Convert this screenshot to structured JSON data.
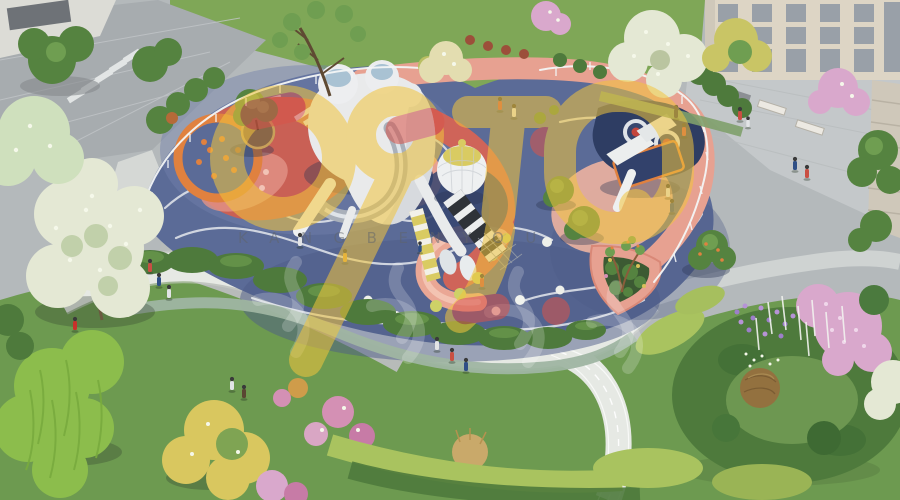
{
  "meta": {
    "alt": "Aerial 3D rendering of a colorful children's playground with white inflatable-style play structures, tube slides, trampolines, curved salmon paths on blue rubber surfacing, surrounded by lawns, hedges, flower gardens, winding walkways, blossoming trees and beige apartment buildings"
  },
  "watermark": {
    "subtext": "KANGBENYOU",
    "logo": "stylized rounded bubble-letter brand logo",
    "calligraphy": "faint white brush calligraphy characters"
  },
  "colors": {
    "pave": "#b4b9bb",
    "road": "#a7acaf",
    "plaza": "#c4c8ca",
    "wall": "#dcdcd6",
    "wall_win": "#6e7277",
    "lawn_top": "#7fa757",
    "lawn": "#6d9a50",
    "lawn_dark": "#54793f",
    "play_blue": "#5b6b97",
    "play_blue_light": "#7080ab",
    "play_blue_dark": "#4d5c88",
    "navy": "#2e3d63",
    "salmon": "#e7a191",
    "salmon_light": "#edb3a0",
    "red": "#c96055",
    "red2": "#cf6459",
    "pink_light": "#e8b6aa",
    "orange": "#e0813f",
    "path_white": "#e6e9e4",
    "path_grey": "#cfd3d2",
    "line_white": "#edf0f2",
    "hedge": "#4e7a3c",
    "hedge_light": "#639148",
    "hedge_sage": "#9fb5a2",
    "hedge_bright": "#a9c35f",
    "tree_green": "#558340",
    "tree_green_light": "#6f9e51",
    "tree_dark": "#3e6a33",
    "blossom_white": "#e4e8d4",
    "blossom_pink": "#d9a8cc",
    "blossom_yellow": "#d9c75f",
    "willow": "#8cbd4c",
    "willow_dark": "#79ab3e",
    "bldg": "#ddd5c5",
    "bldg_side": "#cfc8ba",
    "bldg_win": "#99a0a8",
    "soil": "#8a6748",
    "planter_brown": "#9b7a4e",
    "struct_white": "#e9eaeb",
    "struct_shade": "#cfd3d9",
    "silver": "#a9b0ba",
    "silver_hi": "#dfe4e9",
    "glass": "#a9c2d3",
    "canopy_dark": "#2f3338",
    "canopy_stripe": "#eceeee",
    "slide_yellow": "#d9cb62",
    "dot_yellow": "#ced167",
    "dot_white": "#eef0ea",
    "topiary_brown": "#93713f",
    "purple": "#9d7fc9",
    "pink_shrub": "#d490b4",
    "wm_yellow": "#f2c53d",
    "wm_red": "#d9544a",
    "wm_text": "#5f646a"
  }
}
